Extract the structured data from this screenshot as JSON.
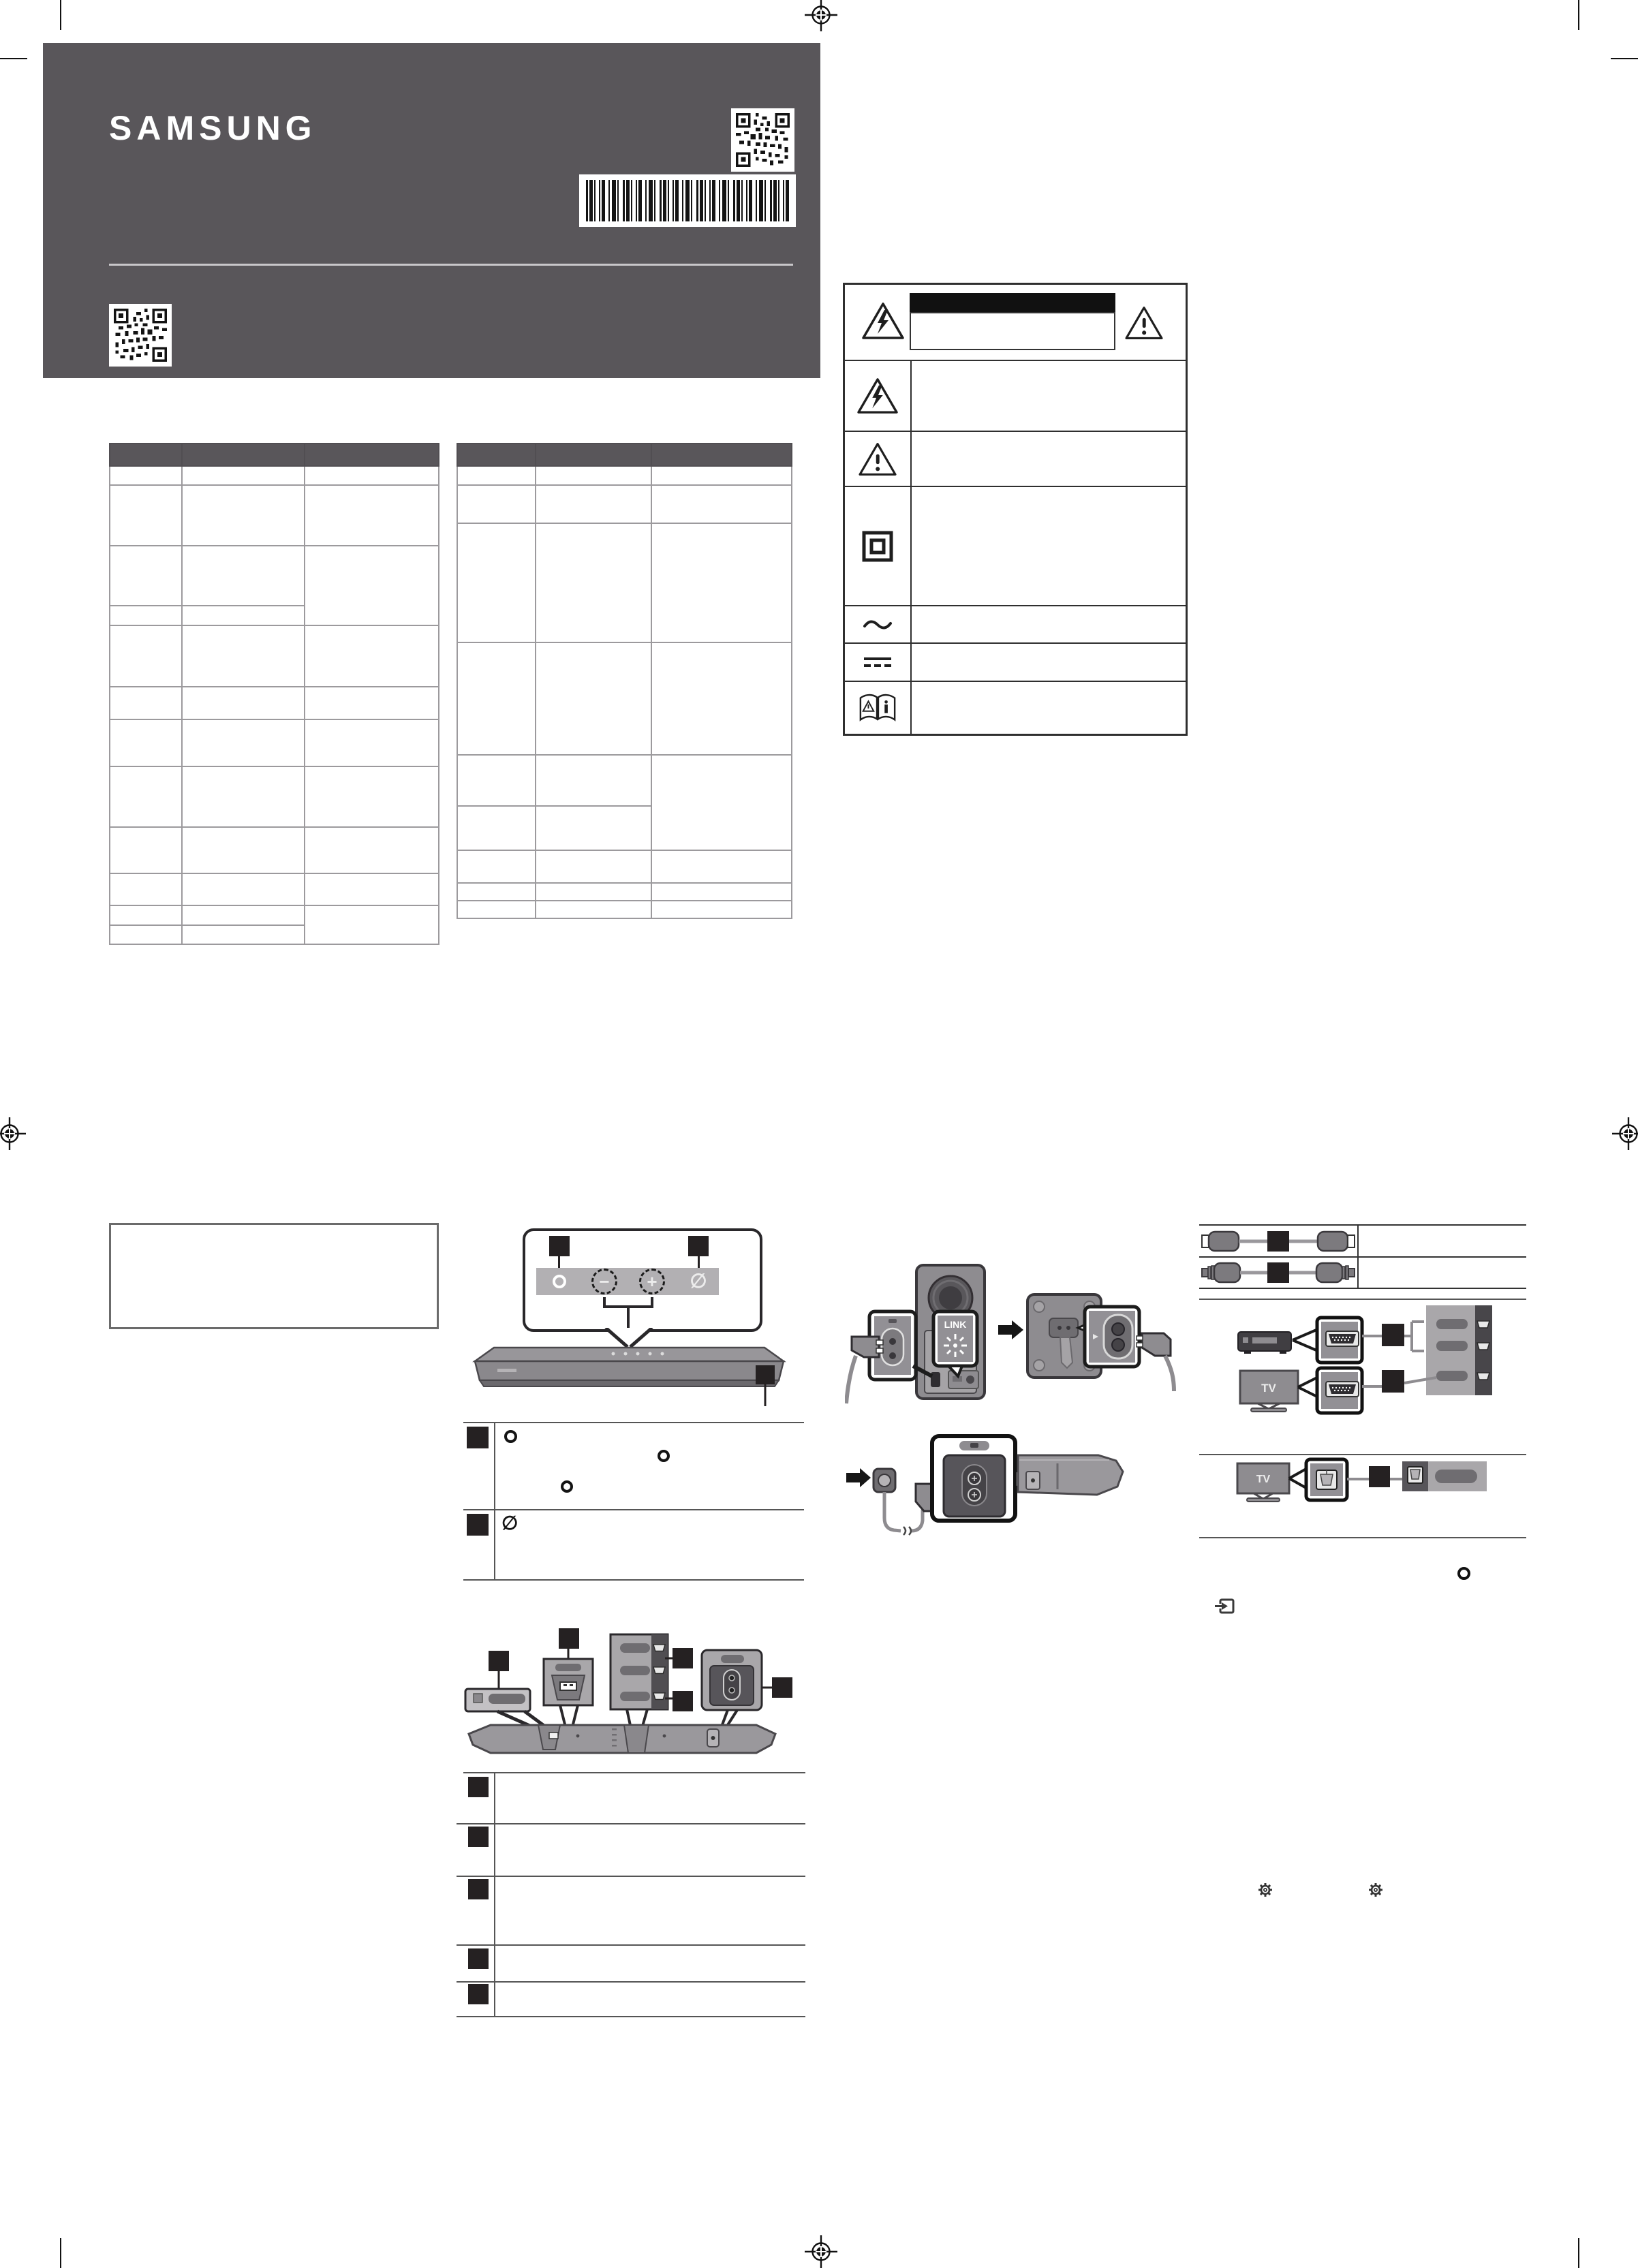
{
  "document": {
    "type": "scanned quick start guide page",
    "brand": "SAMSUNG"
  },
  "colors": {
    "header_bg": "#59565a",
    "black_label": "#252122",
    "table_border": "#9c9a9d",
    "safety_border": "#2f2f2f",
    "diagram_mid": "#9a989c",
    "diagram_panel": "#a9a7aa",
    "diagram_dark": "#6f6d71",
    "diagram_darker": "#57555a"
  },
  "header": {
    "logo_text": "SAMSUNG",
    "icons": [
      "qr-code",
      "barcode",
      "qr-code"
    ]
  },
  "spec_table_1": {
    "headers": [
      "",
      "",
      ""
    ],
    "rows": [
      [
        "",
        "",
        ""
      ],
      [
        "",
        "",
        ""
      ],
      [
        "",
        "",
        ""
      ],
      [
        "",
        "",
        ""
      ],
      [
        "",
        "",
        ""
      ],
      [
        "",
        "",
        ""
      ],
      [
        "",
        "",
        ""
      ],
      [
        "",
        "",
        ""
      ],
      [
        "",
        "",
        ""
      ],
      [
        "",
        "",
        ""
      ],
      [
        "",
        "",
        ""
      ],
      [
        "",
        "",
        ""
      ]
    ]
  },
  "spec_table_2": {
    "headers": [
      "",
      "",
      ""
    ],
    "rows": [
      [
        "",
        "",
        ""
      ],
      [
        "",
        "",
        ""
      ],
      [
        "",
        "",
        ""
      ],
      [
        "",
        "",
        ""
      ],
      [
        "",
        "",
        ""
      ],
      [
        "",
        "",
        ""
      ],
      [
        "",
        "",
        ""
      ],
      [
        "",
        "",
        ""
      ],
      [
        "",
        "",
        ""
      ]
    ]
  },
  "safety_symbols": {
    "rows": [
      {
        "icons": [
          "bolt-triangle",
          "caution-black-bar",
          "caution-box",
          "exclamation-triangle"
        ],
        "text": ""
      },
      {
        "icon": "bolt-triangle",
        "text": ""
      },
      {
        "icon": "exclamation-triangle",
        "text": ""
      },
      {
        "icon": "class-ii-double-square",
        "text": ""
      },
      {
        "icon": "ac-voltage-tilde",
        "text": ""
      },
      {
        "icon": "dc-voltage",
        "text": ""
      },
      {
        "icon": "refer-to-manual-book",
        "text": ""
      }
    ]
  },
  "glyphs": {
    "minus": "−",
    "plus": "+",
    "mic_off": "∅"
  },
  "top_panel_buttons": [
    {
      "icon": "multi-function-ring"
    },
    {
      "icon": "volume-minus",
      "glyph": "−"
    },
    {
      "icon": "volume-plus",
      "glyph": "+"
    },
    {
      "icon": "mic-off",
      "glyph": "∅"
    }
  ],
  "button_list": {
    "rows": [
      {
        "lead_icon": "multi-function-ring",
        "text": ""
      },
      {
        "lead_icon": "mic-off",
        "text": ""
      }
    ]
  },
  "port_list": {
    "rows": [
      "",
      "",
      "",
      "",
      ""
    ]
  },
  "cable_list": {
    "rows": [
      {
        "icon": "hdmi-cable",
        "text": ""
      },
      {
        "icon": "optical-cable",
        "text": ""
      }
    ]
  },
  "subwoofer": {
    "link_label": "LINK"
  },
  "connections": {
    "hdmi_tv_label": "TV",
    "optical_tv_label": "TV"
  }
}
